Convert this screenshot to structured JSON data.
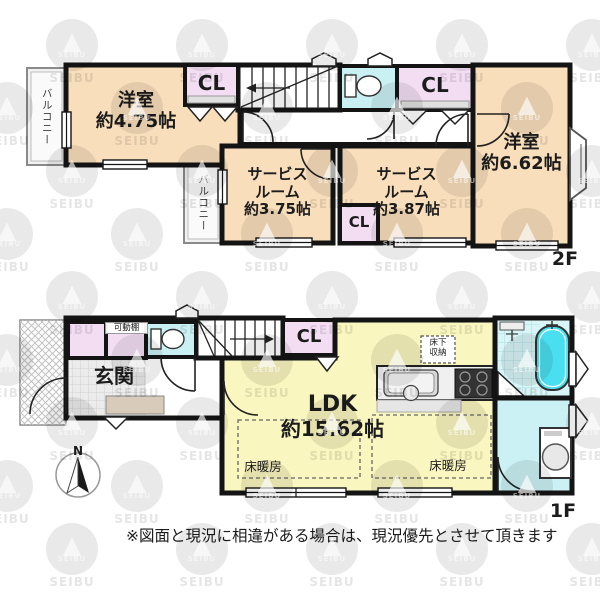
{
  "watermark": {
    "text": "SEIBU"
  },
  "colors": {
    "room": "#F8DEBB",
    "closet": "#F2DDF3",
    "water": "#C9F0F3",
    "ldk": "#FAF6BF",
    "bath-tile": "#D8F5F7",
    "tub": "#4ADFF0",
    "step": "#D8CBB9",
    "wall": "#141414"
  },
  "floor2": {
    "badge": "2F",
    "balcony_left": "バルコニー",
    "balcony_middle": "バルコニー",
    "bedroom_small": {
      "name": "洋室",
      "size": "約4.75帖"
    },
    "closet_left": "CL",
    "closet_right": "CL",
    "closet_small": "CL",
    "bedroom_large": {
      "name": "洋室",
      "size": "約6.62帖"
    },
    "service_left": {
      "line1": "サービス",
      "line2": "ルーム",
      "size": "約3.75帖"
    },
    "service_right": {
      "line1": "サービス",
      "line2": "ルーム",
      "size": "約3.87帖"
    }
  },
  "floor1": {
    "badge": "1F",
    "entrance": "玄関",
    "movable_shelf": "可動棚",
    "closet": "CL",
    "ldk": {
      "name": "LDK",
      "size": "約15.62帖"
    },
    "underfloor": {
      "line1": "床下",
      "line2": "収納"
    },
    "floor_heating_left": "床暖房",
    "floor_heating_right": "床暖房",
    "compass_n": "N"
  },
  "footer": {
    "disclaimer": "※図面と現況に相違がある場合は、現況優先とさせて頂きます"
  }
}
